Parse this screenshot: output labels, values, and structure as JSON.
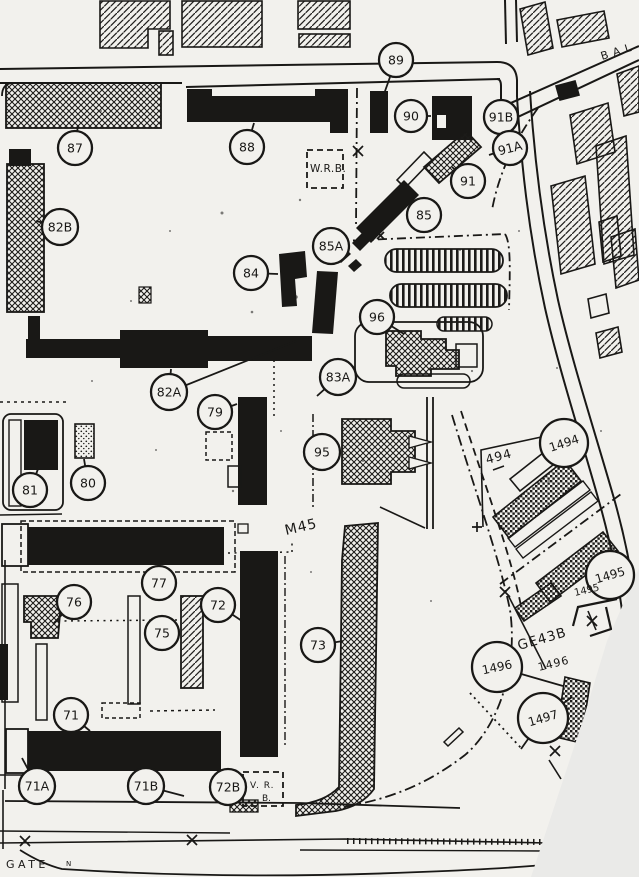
{
  "map": {
    "paper_color": "#f2f1ed",
    "ink_color": "#191816",
    "page_cut_color": "#eaeae8"
  },
  "markers": [
    {
      "label": "87",
      "x": 75,
      "y": 148,
      "r": 17,
      "leaders": [
        [
          78,
          125
        ]
      ]
    },
    {
      "label": "88",
      "x": 247,
      "y": 147,
      "r": 17,
      "leaders": [
        [
          254,
          123
        ]
      ]
    },
    {
      "label": "89",
      "x": 396,
      "y": 60,
      "r": 17,
      "leaders": [
        [
          384,
          94
        ]
      ]
    },
    {
      "label": "90",
      "x": 411,
      "y": 116,
      "r": 16,
      "leaders": [
        [
          431,
          116
        ]
      ]
    },
    {
      "label": "91B",
      "x": 501,
      "y": 117,
      "r": 17,
      "leaders": [
        [
          483,
          119
        ]
      ]
    },
    {
      "label": "91A",
      "x": 510,
      "y": 148,
      "r": 17,
      "rot": -14,
      "leaders": [
        [
          489,
          155
        ]
      ]
    },
    {
      "label": "91",
      "x": 468,
      "y": 181,
      "r": 17,
      "leaders": [
        [
          452,
          167
        ]
      ]
    },
    {
      "label": "82B",
      "x": 60,
      "y": 227,
      "r": 18,
      "leaders": [
        [
          36,
          221
        ]
      ]
    },
    {
      "label": "85",
      "x": 424,
      "y": 215,
      "r": 17,
      "leaders": [
        [
          413,
          229
        ]
      ]
    },
    {
      "label": "85A",
      "x": 331,
      "y": 246,
      "r": 18,
      "leaders": [
        [
          345,
          258
        ]
      ]
    },
    {
      "label": "84",
      "x": 251,
      "y": 273,
      "r": 17,
      "leaders": [
        [
          278,
          274
        ]
      ]
    },
    {
      "label": "96",
      "x": 377,
      "y": 317,
      "r": 17,
      "leaders": [
        [
          404,
          334
        ]
      ]
    },
    {
      "label": "82A",
      "x": 169,
      "y": 392,
      "r": 18,
      "leaders": [
        [
          171,
          369
        ],
        [
          296,
          341
        ]
      ]
    },
    {
      "label": "83A",
      "x": 338,
      "y": 377,
      "r": 18,
      "leaders": [
        [
          317,
          396
        ]
      ]
    },
    {
      "label": "79",
      "x": 215,
      "y": 412,
      "r": 17,
      "leaders": [
        [
          237,
          404
        ]
      ]
    },
    {
      "label": "95",
      "x": 322,
      "y": 452,
      "r": 18,
      "leaders": [
        [
          341,
          452
        ]
      ]
    },
    {
      "label": "80",
      "x": 88,
      "y": 483,
      "r": 17,
      "leaders": [
        [
          84,
          459
        ]
      ]
    },
    {
      "label": "81",
      "x": 30,
      "y": 490,
      "r": 17,
      "leaders": [
        [
          38,
          469
        ]
      ]
    },
    {
      "label": "77",
      "x": 159,
      "y": 583,
      "r": 17,
      "leaders": [
        [
          157,
          566
        ]
      ]
    },
    {
      "label": "76",
      "x": 74,
      "y": 602,
      "r": 17,
      "leaders": [
        [
          53,
          624
        ]
      ]
    },
    {
      "label": "75",
      "x": 162,
      "y": 633,
      "r": 17,
      "leaders": [
        [
          180,
          633
        ]
      ]
    },
    {
      "label": "72",
      "x": 218,
      "y": 605,
      "r": 17,
      "leaders": [
        [
          242,
          621
        ]
      ]
    },
    {
      "label": "73",
      "x": 318,
      "y": 645,
      "r": 17,
      "leaders": [
        [
          343,
          641
        ]
      ]
    },
    {
      "label": "71",
      "x": 71,
      "y": 715,
      "r": 17,
      "leaders": [
        [
          90,
          731
        ]
      ]
    },
    {
      "label": "71A",
      "x": 37,
      "y": 786,
      "r": 18,
      "leaders": [
        [
          22,
          758
        ]
      ]
    },
    {
      "label": "71B",
      "x": 146,
      "y": 786,
      "r": 18,
      "leaders": [
        [
          184,
          796
        ]
      ]
    },
    {
      "label": "72B",
      "x": 228,
      "y": 787,
      "r": 18,
      "leaders": [
        [
          239,
          801
        ]
      ]
    },
    {
      "label": "1494",
      "x": 564,
      "y": 443,
      "r": 24,
      "rot": -18,
      "fs": 12,
      "leaders": [
        [
          549,
          459
        ]
      ]
    },
    {
      "label": "1495",
      "x": 610,
      "y": 575,
      "r": 24,
      "rot": -16,
      "fs": 12,
      "leaders": [
        [
          593,
          588
        ]
      ]
    },
    {
      "label": "1496",
      "x": 497,
      "y": 667,
      "r": 25,
      "rot": -12,
      "fs": 12,
      "leaders": [
        [
          563,
          686
        ]
      ]
    },
    {
      "label": "1497",
      "x": 543,
      "y": 718,
      "r": 25,
      "rot": -16,
      "fs": 12,
      "leaders": [
        [
          572,
          697
        ],
        [
          521,
          749
        ]
      ]
    }
  ],
  "labels": [
    {
      "text": "BAL",
      "x": 602,
      "y": 60,
      "rot": -17,
      "size": 11,
      "ls": 5
    },
    {
      "text": "W.R.B.",
      "x": 310,
      "y": 172,
      "size": 10.5,
      "ls": 0.5
    },
    {
      "text": "M45",
      "x": 286,
      "y": 535,
      "rot": -13,
      "size": 14,
      "ls": 1
    },
    {
      "text": "494",
      "x": 487,
      "y": 464,
      "rot": -15,
      "size": 12.5,
      "ls": 1
    },
    {
      "text": "1495",
      "x": 575,
      "y": 596,
      "rot": -13,
      "size": 10,
      "ls": 0
    },
    {
      "text": "GE43B",
      "x": 519,
      "y": 650,
      "rot": -16,
      "size": 13.5,
      "ls": 1
    },
    {
      "text": "1496",
      "x": 539,
      "y": 671,
      "rot": -14,
      "size": 11,
      "ls": 1
    },
    {
      "text": "V. R.",
      "x": 250,
      "y": 788,
      "size": 9,
      "ls": 1
    },
    {
      "text": "B.",
      "x": 262,
      "y": 801,
      "size": 9,
      "ls": 0
    },
    {
      "text": "GATE",
      "x": 6,
      "y": 868,
      "size": 11,
      "ls": 3.5
    },
    {
      "text": "N",
      "x": 66,
      "y": 866,
      "size": 7,
      "ls": 0
    }
  ]
}
